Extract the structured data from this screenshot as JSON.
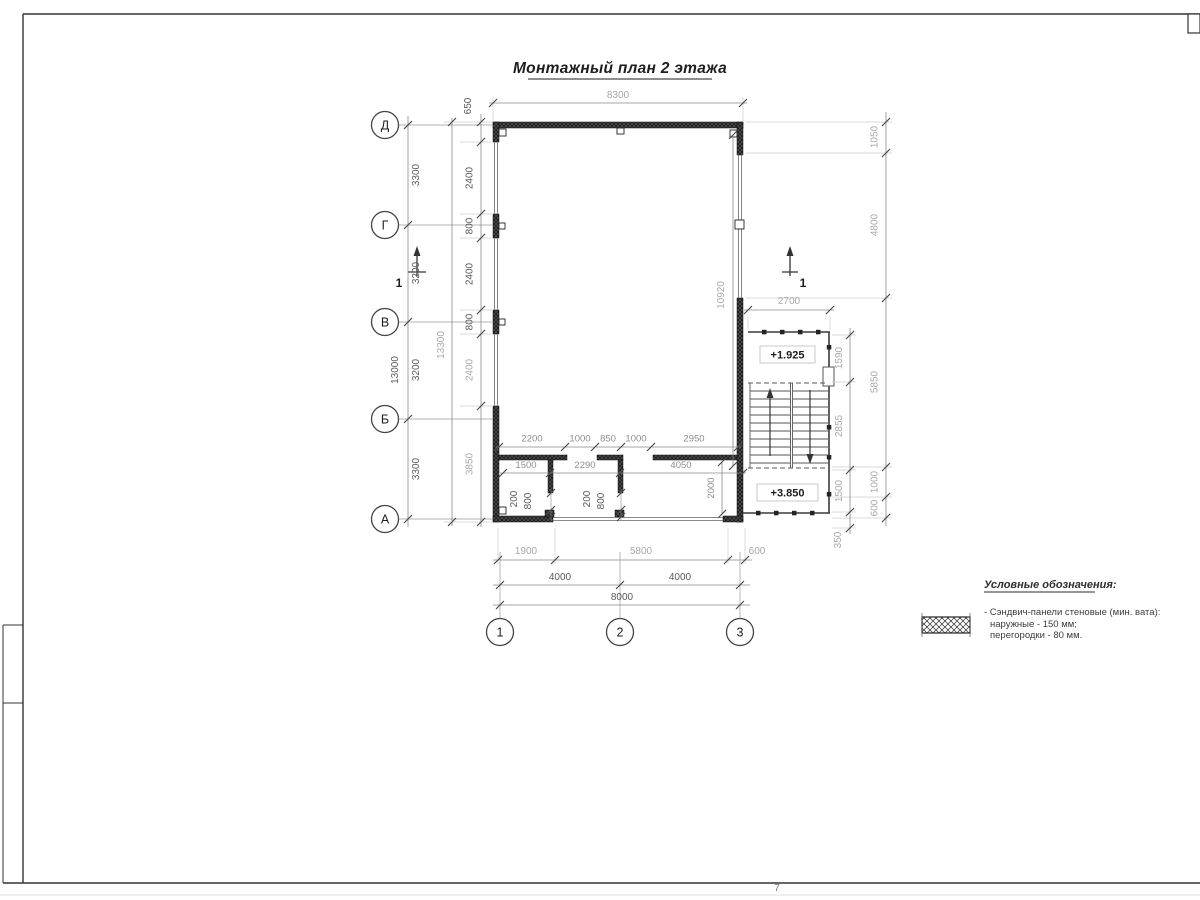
{
  "sheet": {
    "title": "Монтажный план 2 этажа",
    "page_number": "7"
  },
  "axes": {
    "rows": [
      "Д",
      "Г",
      "В",
      "Б",
      "А"
    ],
    "cols": [
      "1",
      "2",
      "3"
    ]
  },
  "section_mark": {
    "label": "1"
  },
  "levels": {
    "intermediate_landing": "+1.925",
    "second_floor": "+3.850"
  },
  "dimensions": {
    "top_width": "8300",
    "axis_spacing_left": [
      "3300",
      "3200",
      "3200",
      "3300"
    ],
    "axis_total_left": "13000",
    "overall_left": "13300",
    "left_wall_segments": [
      "650",
      "2400",
      "800",
      "2400",
      "800",
      "2400",
      "3850"
    ],
    "right_overall": [
      "1050",
      "4800",
      "5850",
      "1000",
      "600"
    ],
    "stair_block_vertical": [
      "1590",
      "2855",
      "1500",
      "350"
    ],
    "stair_block_width": "2700",
    "right_wall_glazing": "10920",
    "interior_top_row": [
      "2200",
      "1000",
      "850",
      "1000",
      "2950"
    ],
    "interior_room_row": [
      "1500",
      "2290",
      "4050"
    ],
    "interior_depth": "2000",
    "door_left": [
      "200",
      "800"
    ],
    "door_right": [
      "200",
      "800"
    ],
    "bottom_segments": [
      "1900",
      "5800",
      "600"
    ],
    "bottom_axis_spacing": [
      "4000",
      "4000"
    ],
    "bottom_total": "8000"
  },
  "legend": {
    "title": "Условные обозначения:",
    "items": [
      {
        "symbol": "cross-hatch-panel-swatch",
        "lines": [
          "- Сэндвич-панели стеновые (мин. вата):",
          "наружные - 150 мм;",
          "перегородки - 80 мм."
        ]
      }
    ]
  },
  "colors": {
    "wall_fill": "#1d1d1d",
    "dim_dark": "#5a5a5a",
    "dim_light": "#a8a8a8",
    "frame": "#333333"
  }
}
